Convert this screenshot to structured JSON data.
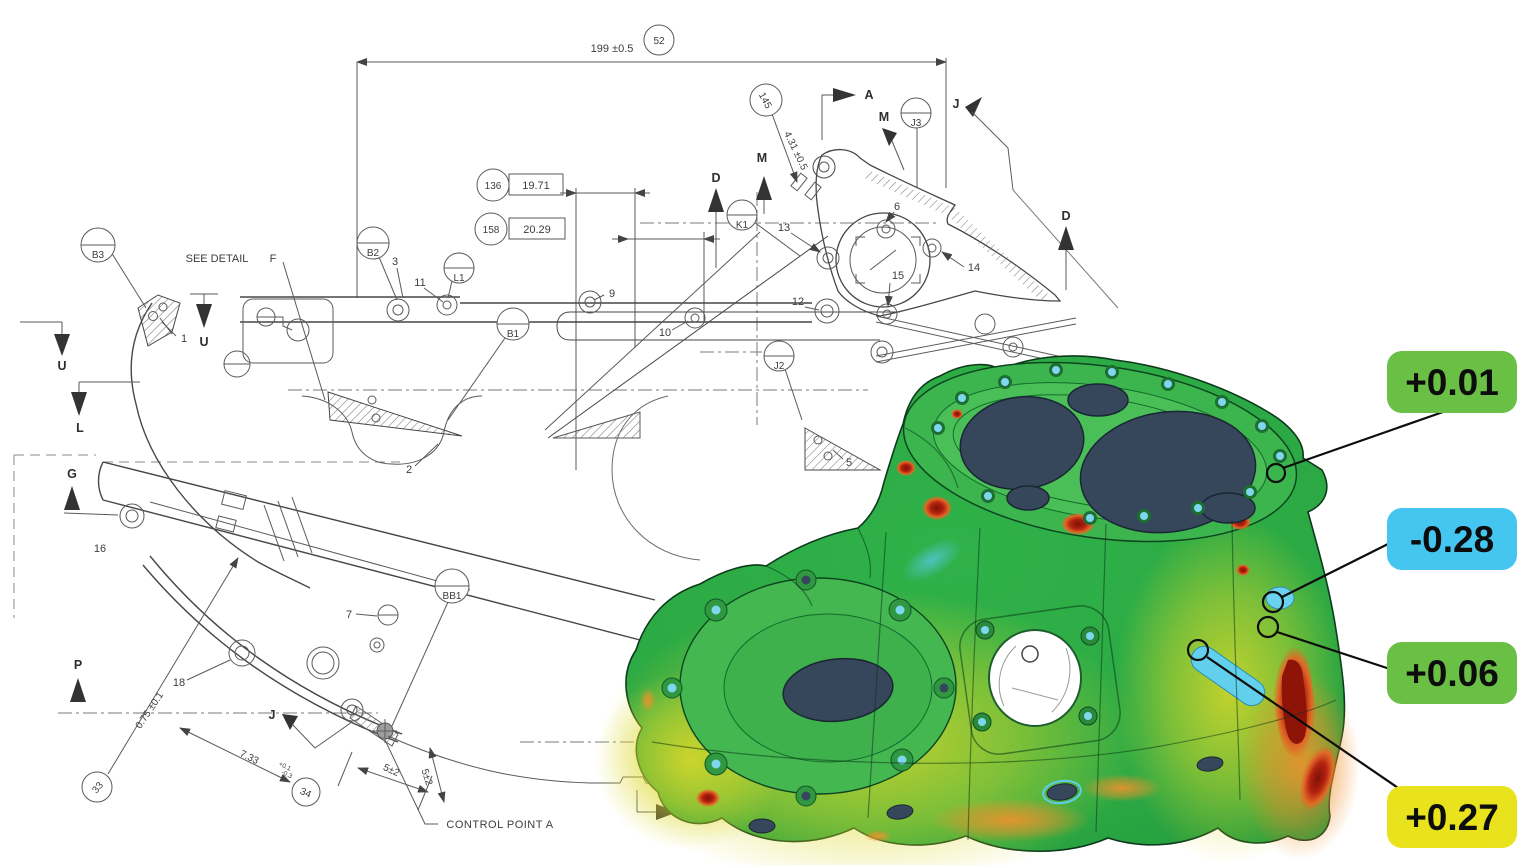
{
  "drawing": {
    "dimensions": {
      "overall": "199 ±0.5",
      "d431": "4.31 ±0.5",
      "d1971": "19.71",
      "d2029": "20.29",
      "d075": "0.75 ±0.1",
      "d733": "7.33",
      "d733_tol_upper": "+0.1",
      "d733_tol_lower": "-0.3",
      "d5_a": "5±2",
      "d5_b": "5±2"
    },
    "balloons": {
      "n52": "52",
      "n145": "145",
      "n136": "136",
      "n158": "158",
      "n33": "33",
      "n34": "34"
    },
    "datum_targets": {
      "b3": "B3",
      "b2": "B2",
      "l1": "L1",
      "b1": "B1",
      "bb1": "BB1",
      "j2": "J2",
      "j3": "J3",
      "k1": "K1"
    },
    "items": {
      "i1": "1",
      "i2": "2",
      "i3": "3",
      "i5": "5",
      "i6": "6",
      "i7": "7",
      "i9": "9",
      "i10": "10",
      "i11": "11",
      "i12": "12",
      "i13": "13",
      "i14": "14",
      "i15": "15",
      "i16": "16",
      "i18": "18"
    },
    "view_labels": {
      "a": "A",
      "m1": "M",
      "m2": "M",
      "j_top": "J",
      "j_bottom": "J",
      "d1": "D",
      "d2": "D",
      "u1": "U",
      "u2": "U",
      "l": "L",
      "g": "G",
      "p": "P"
    },
    "notes": {
      "see_detail": "SEE DETAIL",
      "detail_ref": "F",
      "control_point": "CONTROL POINT A"
    }
  },
  "inspection": {
    "callouts": [
      {
        "value": "+0.01",
        "color": "#6abf45"
      },
      {
        "value": "-0.28",
        "color": "#45c6f1"
      },
      {
        "value": "+0.06",
        "color": "#6abf45"
      },
      {
        "value": "+0.27",
        "color": "#e8e31d"
      }
    ],
    "heatmap_palette": {
      "nominal_green": "#2fb148",
      "flange_green": "#45bc53",
      "deviation_yellow": "#ddd92a",
      "deviation_orange": "#f0912c",
      "deviation_red": "#a81c0a",
      "deviation_cyan": "#62cfec",
      "bore_fill": "#36475b"
    }
  }
}
